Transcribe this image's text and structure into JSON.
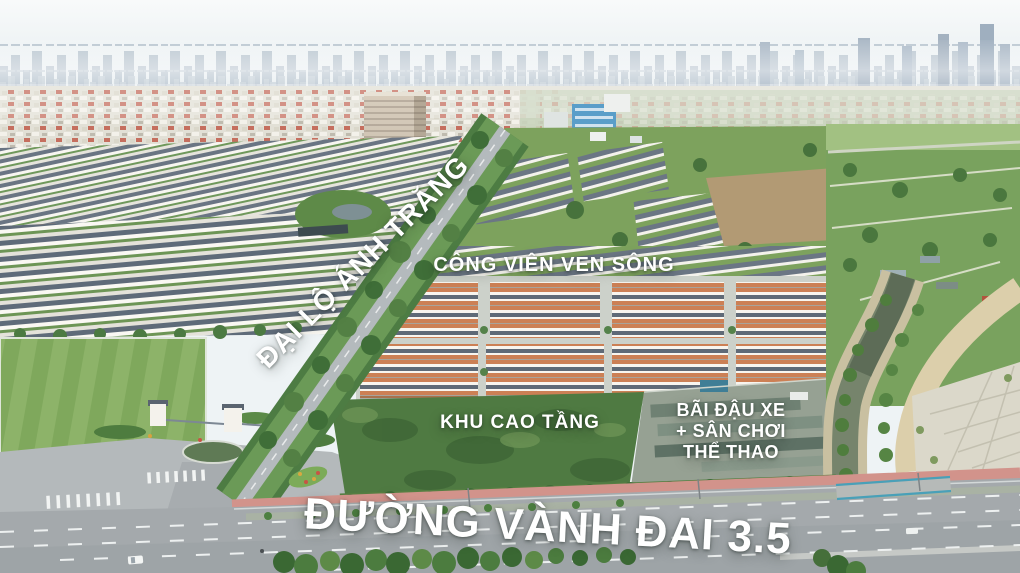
{
  "labels": {
    "avenue": "ĐẠI LỘ ÁNH TRĂNG",
    "riverside_park": "CÔNG VIÊN VEN SÔNG",
    "high_rise_zone": "KHU CAO TẦNG",
    "parking": {
      "line1": "BÃI ĐẬU XE",
      "line2": "+ SÂN CHƠI",
      "line3": "THỂ THAO"
    },
    "ring_road": "ĐƯỜNG VÀNH ĐAI 3.5"
  },
  "colors": {
    "label_text": "#ffffff",
    "sky": "#eef3f5",
    "skyline": "#b2bfcb",
    "vegetation": "#5e8a4a",
    "dense_green": "#3f6e38",
    "canal_water": "#76846c",
    "asphalt": "#a4a9ac",
    "pink_sidewalk": "#d2938b",
    "roof_orange": "#cc8055",
    "roof_slate": "#5f6a77",
    "facade_white": "#f7f5ef",
    "sand_road": "#dccfab"
  }
}
